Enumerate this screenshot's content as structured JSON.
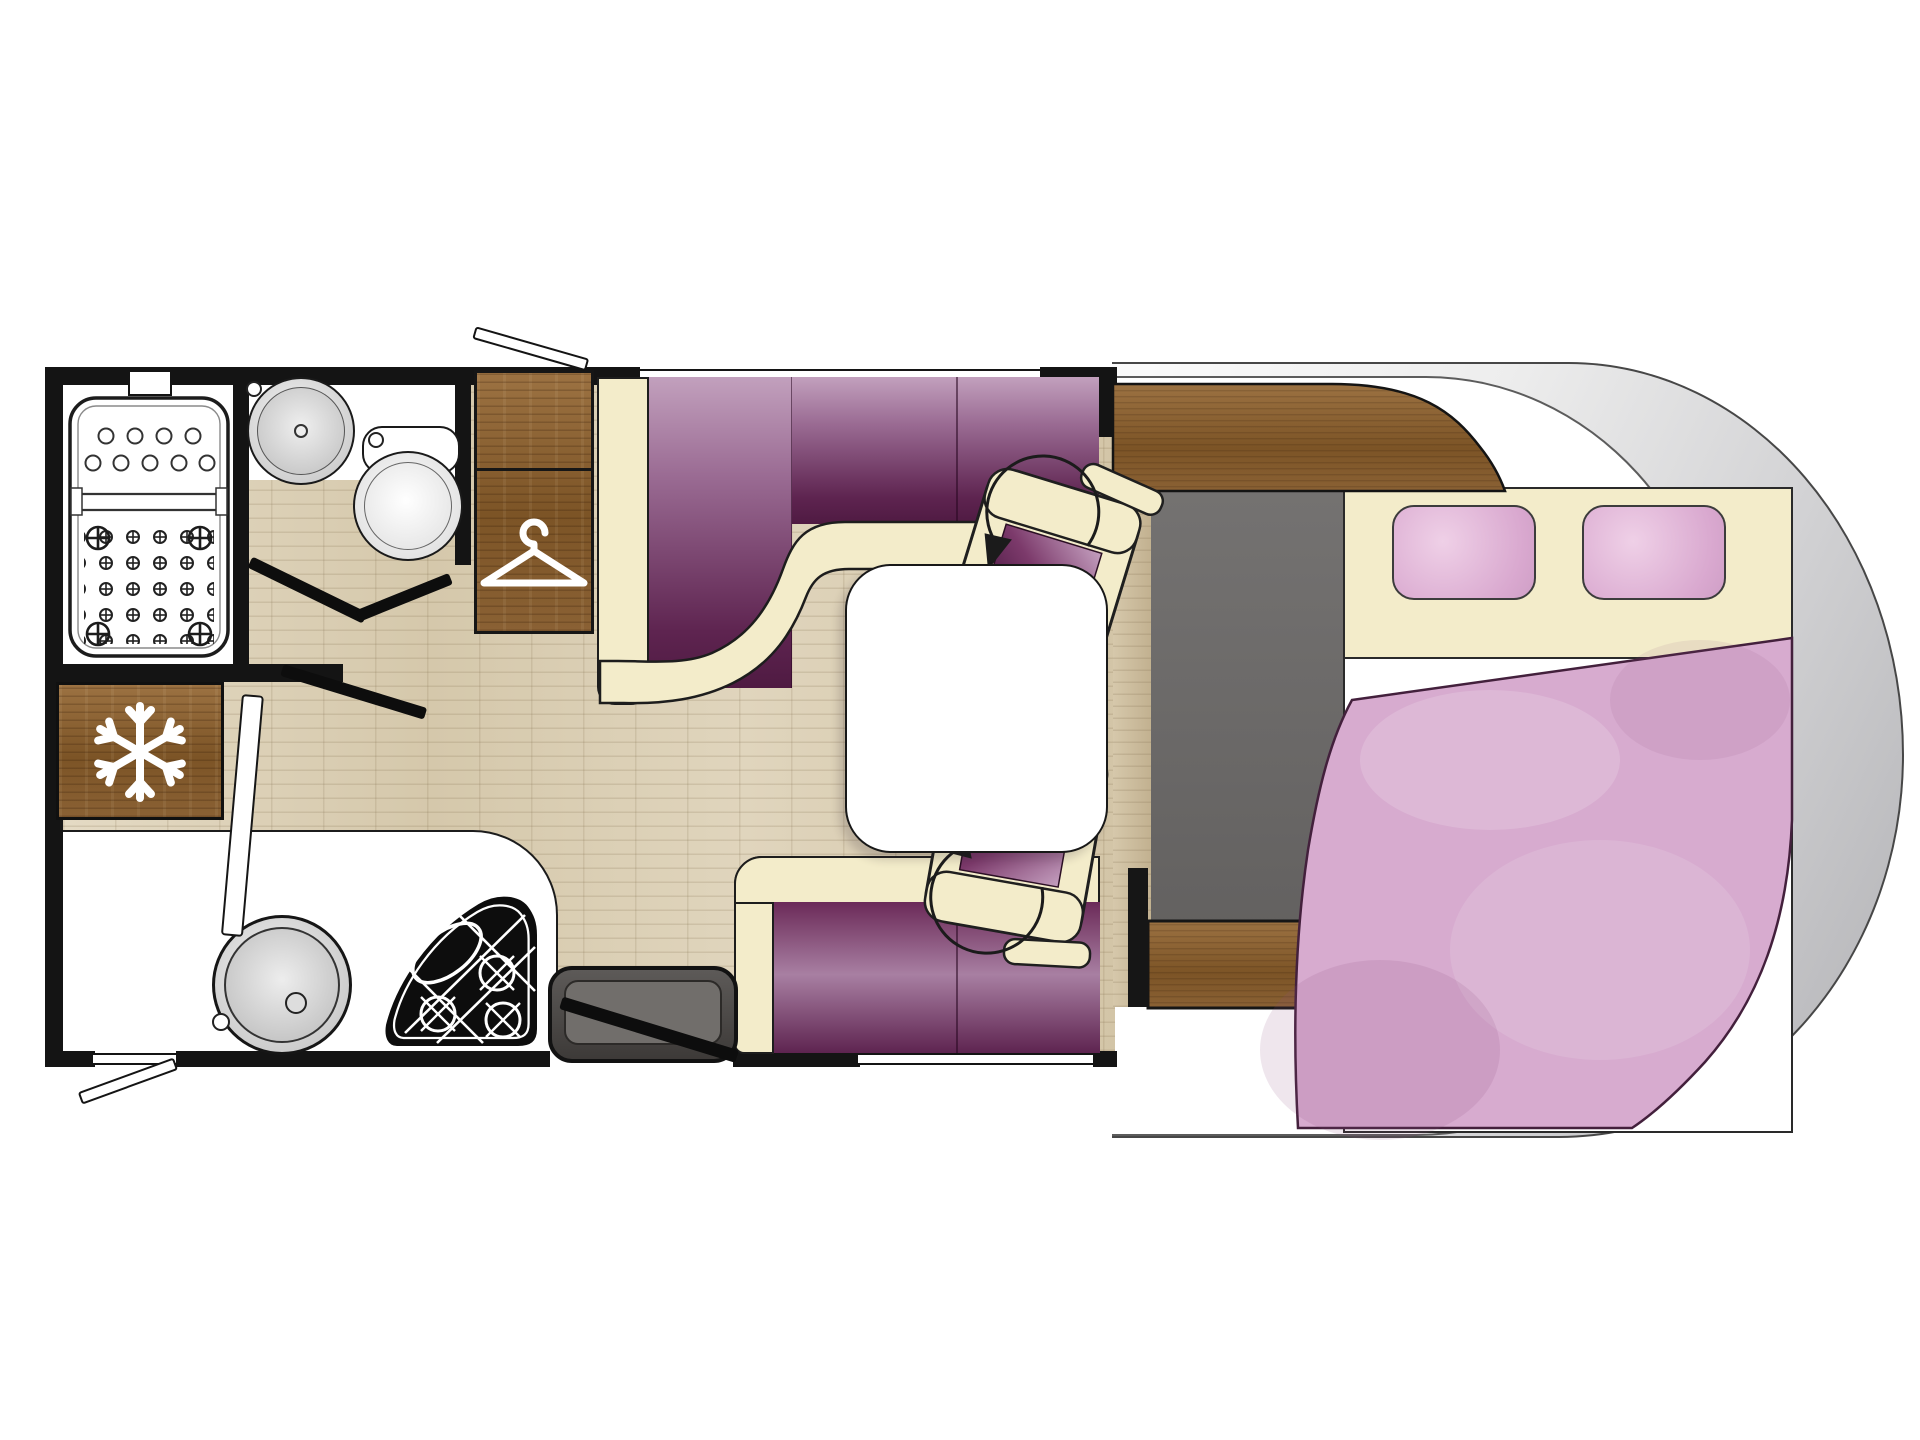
{
  "meta": {
    "title": "Motorhome floor plan, top view",
    "visible_text": [],
    "view": "top-down 2D layout, rear of vehicle at left, driver cab at right"
  },
  "palette": {
    "wall": "#141414",
    "floor": "#ddd2b9",
    "wood": "#8a6134",
    "cream": "#f3ecca",
    "purple-dark": "#4f1a42",
    "purple-light": "#c9aac6",
    "cabfloor": "#6b6968",
    "silver": "#c6c6c8",
    "blanket": "#d7abcf",
    "pillow": "#e3b9d9",
    "white": "#ffffff",
    "step": "#454240"
  },
  "rooms": [
    {
      "name": "shower-room",
      "position": "rear top-left",
      "features": [
        "shower-tray with drain holes",
        "roof vent"
      ]
    },
    {
      "name": "washroom",
      "position": "top-left",
      "features": [
        "washbasin",
        "toilet",
        "bi-fold doors"
      ]
    },
    {
      "name": "wardrobe",
      "position": "top centre-left",
      "icon": "hanger-icon"
    },
    {
      "name": "kitchen",
      "position": "bottom-left",
      "features": [
        "round sink",
        "3-burner hob",
        "refrigerator"
      ]
    },
    {
      "name": "dinette",
      "position": "centre",
      "features": [
        "L-shaped sofa",
        "rear-facing sofa",
        "white table"
      ]
    },
    {
      "name": "cab",
      "position": "right",
      "features": [
        "two swivel seats with rotation arrows",
        "wood dashboard shelf",
        "grey cab floor"
      ]
    },
    {
      "name": "bedroom",
      "position": "far right",
      "features": [
        "double bed",
        "two pink pillows",
        "pink duvet"
      ]
    }
  ],
  "fixtures": [
    {
      "name": "shower-tray"
    },
    {
      "name": "washbasin"
    },
    {
      "name": "toilet"
    },
    {
      "name": "refrigerator",
      "icon": "snowflake-icon"
    },
    {
      "name": "wardrobe-cabinet",
      "icon": "hanger-icon"
    },
    {
      "name": "kitchen-sink"
    },
    {
      "name": "hob-3-burner"
    },
    {
      "name": "entry-step"
    },
    {
      "name": "entry-door"
    },
    {
      "name": "dinette-sofa-front",
      "upholstery": "purple gradient with cream trim"
    },
    {
      "name": "dinette-sofa-rear",
      "upholstery": "purple gradient with cream trim"
    },
    {
      "name": "dining-table"
    },
    {
      "name": "swivel-seat-front",
      "icon": "rotation-arrow-icon"
    },
    {
      "name": "swivel-seat-rear",
      "icon": "rotation-arrow-icon"
    },
    {
      "name": "double-bed"
    },
    {
      "name": "pillow",
      "count": 2
    },
    {
      "name": "duvet"
    },
    {
      "name": "dashboard-shelf"
    },
    {
      "name": "window-flap",
      "count": 2
    },
    {
      "name": "bathroom-door-leaves",
      "count": 4
    }
  ]
}
